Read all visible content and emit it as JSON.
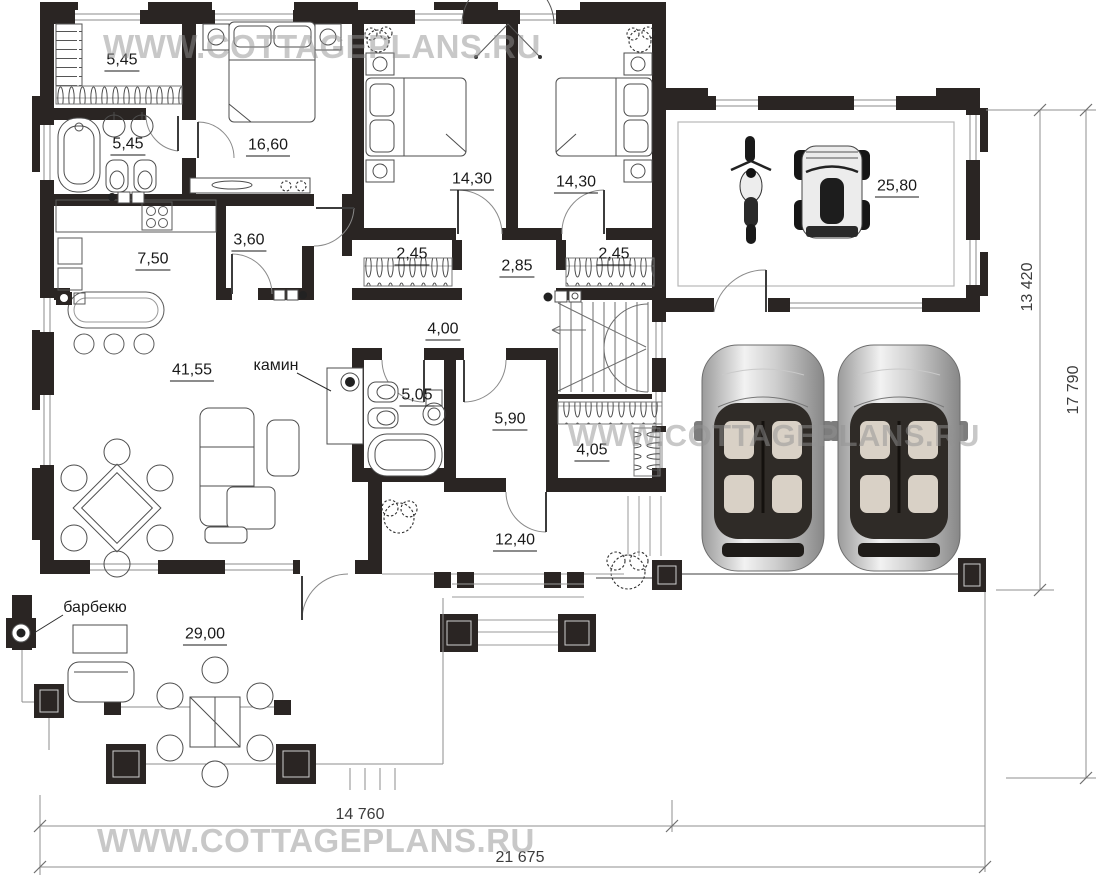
{
  "watermark": {
    "text": "WWW.COTTAGEPLANS.RU"
  },
  "rooms": [
    {
      "id": "dressing-top",
      "area": "5,45"
    },
    {
      "id": "bathroom-top",
      "area": "5,45"
    },
    {
      "id": "bedroom-master",
      "area": "16,60"
    },
    {
      "id": "bedroom-2",
      "area": "14,30"
    },
    {
      "id": "bedroom-3",
      "area": "14,30"
    },
    {
      "id": "garage",
      "area": "25,80"
    },
    {
      "id": "pantry",
      "area": "3,60"
    },
    {
      "id": "kitchen",
      "area": "7,50"
    },
    {
      "id": "wardrobe-left",
      "area": "2,45"
    },
    {
      "id": "hall-bedrooms",
      "area": "2,85"
    },
    {
      "id": "wardrobe-right",
      "area": "2,45"
    },
    {
      "id": "hallway",
      "area": "4,00"
    },
    {
      "id": "living-room",
      "area": "41,55"
    },
    {
      "id": "bathroom-main",
      "area": "5,05"
    },
    {
      "id": "laundry",
      "area": "5,90"
    },
    {
      "id": "wardrobe-hall",
      "area": "4,05"
    },
    {
      "id": "terrace-entry",
      "area": "12,40"
    },
    {
      "id": "terrace-barbecue",
      "area": "29,00"
    }
  ],
  "annotations": {
    "fireplace": "камин",
    "barbecue": "барбекю"
  },
  "dimensions": {
    "side_garage": "13 420",
    "side_total": "17 790",
    "bottom_house": "14 760",
    "bottom_total": "21 675"
  }
}
